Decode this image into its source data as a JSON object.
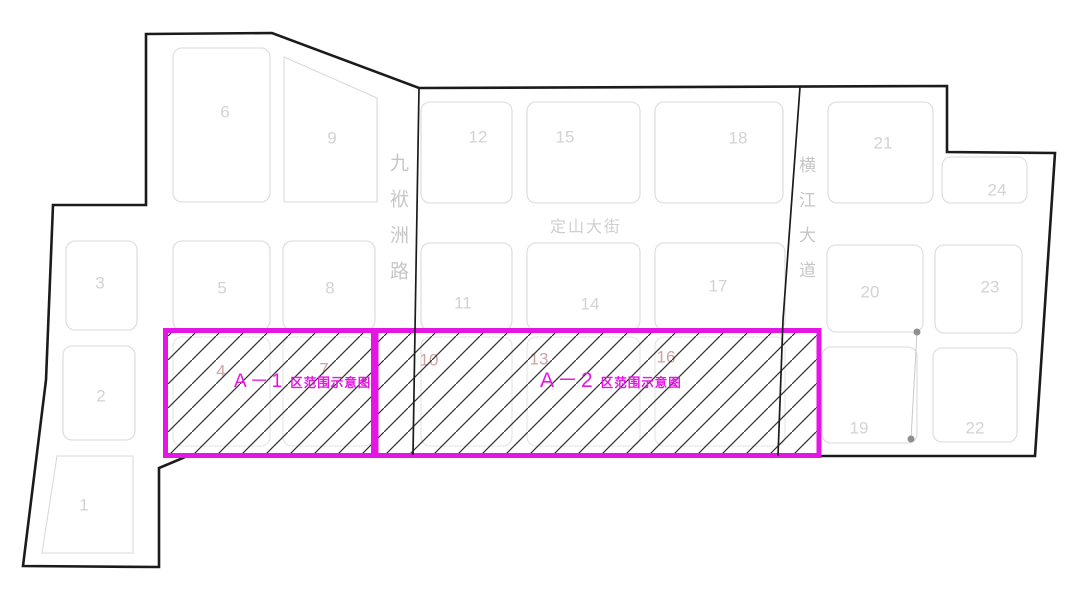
{
  "figure": {
    "type": "land-parcel zoning plan",
    "background": "#ffffff"
  },
  "colors": {
    "boundary": "#1b1b1b",
    "parcel_outline": "#dadada",
    "parcel_number": "#d3d3d3",
    "highlight_number": "#cfa3a3",
    "street_label": "#c6c6c6",
    "zone_accent": "#e516e5",
    "hatch_line": "#2e2e2e",
    "dot": "#8f8f8f"
  },
  "streets": {
    "jiufuzhou": {
      "name": "九袱洲路",
      "orientation": "vertical"
    },
    "dingshan": {
      "name": "定山大街",
      "orientation": "horizontal"
    },
    "hengjiang": {
      "name": "横江大道",
      "orientation": "vertical"
    }
  },
  "zones": {
    "a1": {
      "code": "A－1",
      "label": "区范围示意图"
    },
    "a2": {
      "code": "A－2",
      "label": "区范围示意图"
    }
  },
  "parcels": {
    "blocks": [
      {
        "num": "1",
        "pts": "57,456 133,456 133,553 42,553",
        "lx": 84,
        "ly": 505
      },
      {
        "num": "2",
        "x": 63,
        "y": 346,
        "w": 72,
        "h": 94,
        "lx": 101,
        "ly": 396
      },
      {
        "num": "3",
        "x": 66,
        "y": 241,
        "w": 71,
        "h": 89,
        "lx": 100,
        "ly": 283
      },
      {
        "num": "4",
        "x": 173,
        "y": 337,
        "w": 97,
        "h": 109,
        "lx": 221,
        "ly": 371,
        "faint": true,
        "rose": true
      },
      {
        "num": "5",
        "x": 173,
        "y": 241,
        "w": 97,
        "h": 89,
        "lx": 222,
        "ly": 288
      },
      {
        "num": "6",
        "x": 173,
        "y": 48,
        "w": 97,
        "h": 154,
        "lx": 225,
        "ly": 112
      },
      {
        "num": "7",
        "x": 283,
        "y": 337,
        "w": 90,
        "h": 109,
        "lx": 324,
        "ly": 369,
        "faint": true,
        "rose": true
      },
      {
        "num": "8",
        "x": 283,
        "y": 241,
        "w": 92,
        "h": 89,
        "lx": 330,
        "ly": 288
      },
      {
        "num": "9",
        "pts": "284,57 377,98 377,202 284,202",
        "lx": 332,
        "ly": 138
      },
      {
        "num": "10",
        "x": 421,
        "y": 337,
        "w": 91,
        "h": 109,
        "lx": 429,
        "ly": 360,
        "faint": true,
        "rose": true
      },
      {
        "num": "11",
        "x": 421,
        "y": 243,
        "w": 91,
        "h": 87,
        "lx": 463,
        "ly": 303
      },
      {
        "num": "12",
        "x": 421,
        "y": 102,
        "w": 91,
        "h": 101,
        "lx": 478,
        "ly": 137
      },
      {
        "num": "13",
        "x": 527,
        "y": 337,
        "w": 113,
        "h": 109,
        "lx": 539,
        "ly": 359,
        "faint": true,
        "rose": true
      },
      {
        "num": "14",
        "x": 527,
        "y": 243,
        "w": 113,
        "h": 87,
        "lx": 590,
        "ly": 304
      },
      {
        "num": "15",
        "x": 527,
        "y": 102,
        "w": 113,
        "h": 101,
        "lx": 565,
        "ly": 137
      },
      {
        "num": "16",
        "x": 655,
        "y": 337,
        "w": 130,
        "h": 109,
        "lx": 666,
        "ly": 357,
        "faint": true,
        "rose": true
      },
      {
        "num": "17",
        "x": 655,
        "y": 243,
        "w": 130,
        "h": 87,
        "lx": 718,
        "ly": 286
      },
      {
        "num": "18",
        "x": 655,
        "y": 102,
        "w": 128,
        "h": 101,
        "lx": 738,
        "ly": 138
      },
      {
        "num": "19",
        "x": 822,
        "y": 347,
        "w": 95,
        "h": 96,
        "lx": 859,
        "ly": 428
      },
      {
        "num": "20",
        "x": 827,
        "y": 245,
        "w": 96,
        "h": 87,
        "lx": 870,
        "ly": 292
      },
      {
        "num": "21",
        "x": 828,
        "y": 102,
        "w": 105,
        "h": 101,
        "lx": 883,
        "ly": 143
      },
      {
        "num": "22",
        "x": 933,
        "y": 348,
        "w": 84,
        "h": 94,
        "lx": 975,
        "ly": 428
      },
      {
        "num": "23",
        "x": 935,
        "y": 245,
        "w": 87,
        "h": 88,
        "lx": 990,
        "ly": 287
      },
      {
        "num": "24",
        "x": 942,
        "y": 157,
        "w": 85,
        "h": 46,
        "lx": 997,
        "ly": 190
      }
    ]
  }
}
